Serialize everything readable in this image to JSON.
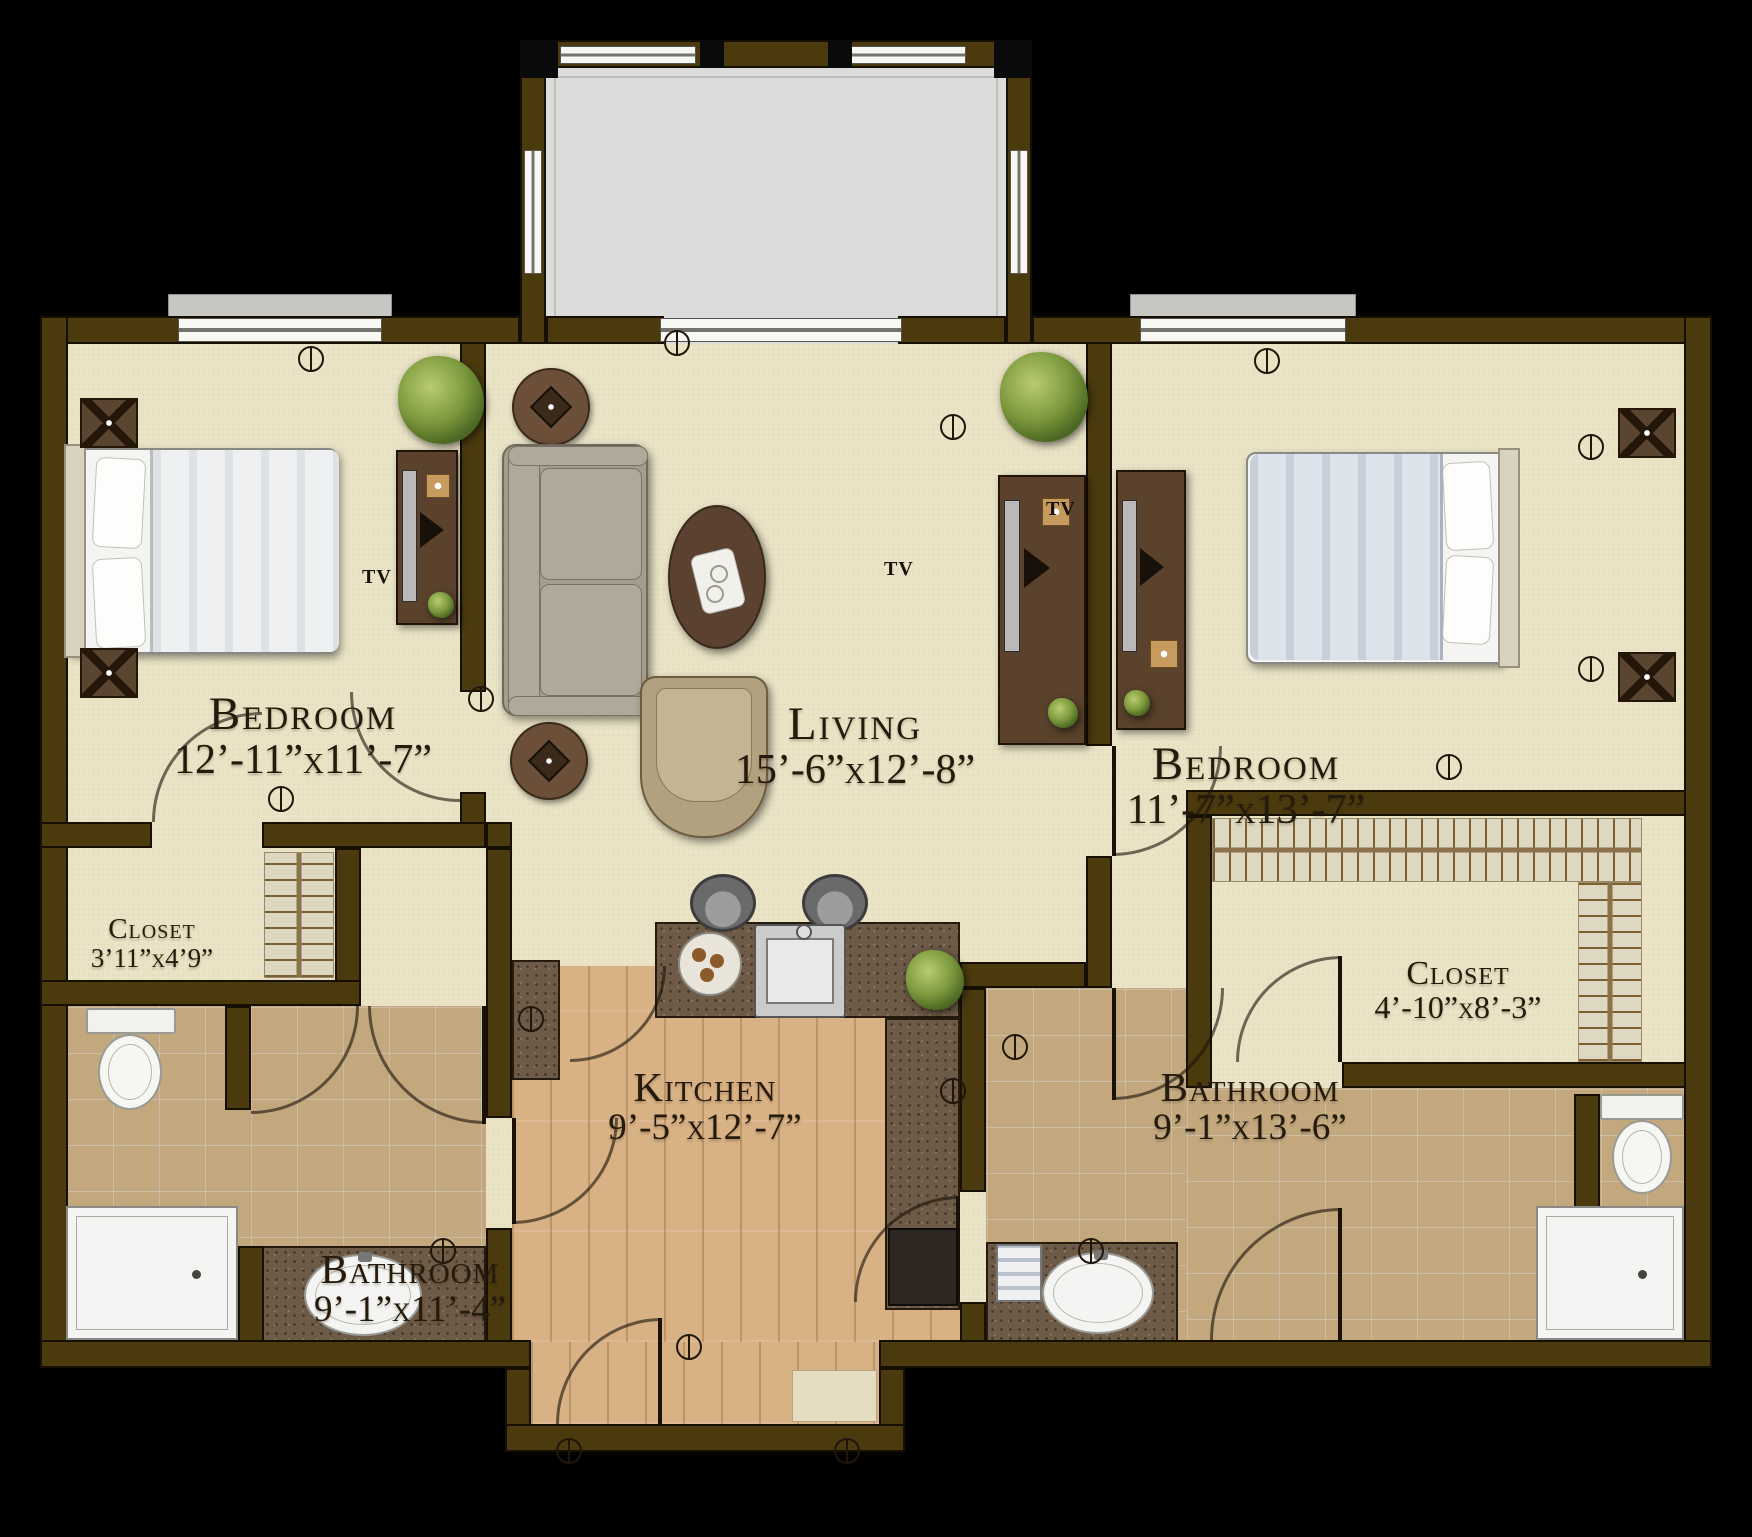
{
  "rooms": {
    "bedroom_left": {
      "name": "Bedroom",
      "dims": "12’-11”x11’-7”"
    },
    "living": {
      "name": "Living",
      "dims": "15’-6”x12’-8”"
    },
    "bedroom_right": {
      "name": "Bedroom",
      "dims": "11’-7”x13’-7”"
    },
    "closet_left": {
      "name": "Closet",
      "dims": "3’11”x4’9”"
    },
    "closet_right": {
      "name": "Closet",
      "dims": "4’-10”x8’-3”"
    },
    "bathroom_left": {
      "name": "Bathroom",
      "dims": "9’-1”x11’-4”"
    },
    "kitchen": {
      "name": "Kitchen",
      "dims": "9’-5”x12’-7”"
    },
    "bathroom_right": {
      "name": "Bathroom",
      "dims": "9’-1”x13’-6”"
    }
  },
  "labels": {
    "tv": "TV"
  },
  "colors": {
    "background": "#000000",
    "wall": "#4a3a0e",
    "wall_outline": "#161004",
    "floor_cream": "#eae3c6",
    "floor_tile": "#c3a87e",
    "floor_wood": "#d8b184",
    "counter": "#6d5a47",
    "patio": "#dcdcdc",
    "label_text": "#251b0d",
    "plant_green": "#6f9136"
  }
}
